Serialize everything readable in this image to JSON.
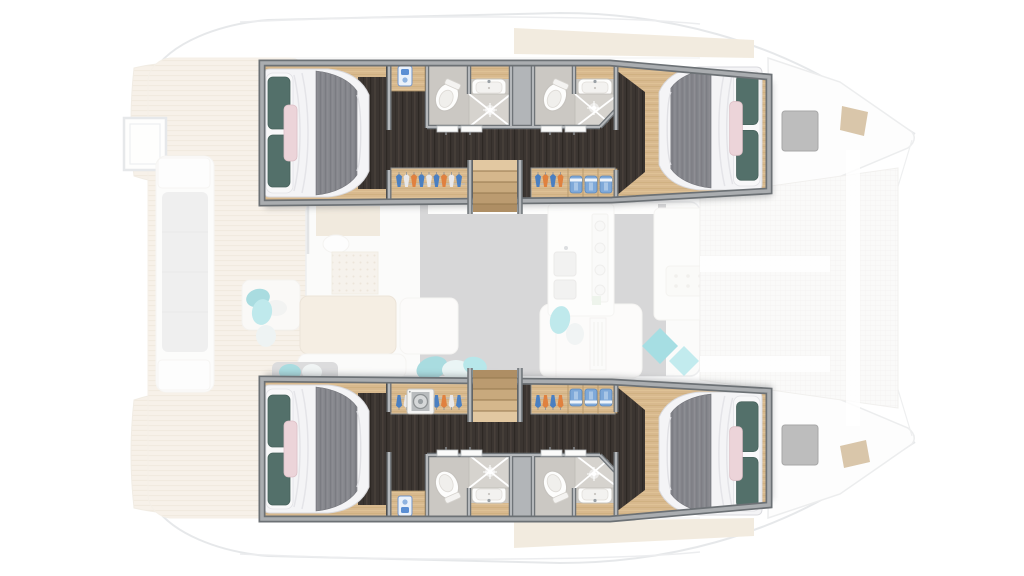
{
  "plan": {
    "title_label": "Catamaran yacht floor plan - 4-cabin lower deck layout, bow to the right",
    "regions": {
      "deck_faded": "Main deck (dimmed): aft cockpit, salon, galley, foredeck",
      "port_suite": "Port hull suite: aft cabin, two bathrooms, wardrobes, stairs, forward cabin",
      "starboard_suite": "Starboard hull suite: aft cabin, two bathrooms, wardrobes, stairs, forward cabin",
      "aft_cabin": "Aft double cabin",
      "forward_cabin": "Forward double cabin",
      "bathroom_aft": "Aft en-suite bathroom with toilet, basin and shower",
      "bathroom_fwd": "Forward en-suite bathroom with toilet, basin and shower",
      "wardrobe_aft": "Wardrobe with hangers",
      "wardrobe_fwd": "Wardrobe with hangers and folded shelves",
      "stairs": "Companionway stairs to saloon",
      "cockpit": "Aft cockpit lounge (dimmed)",
      "salon": "Saloon with dining table and chaise (dimmed)",
      "galley": "Galley with sink and stove (dimmed)",
      "fore_cockpit": "Forward cockpit bench (dimmed)",
      "trampoline": "Bow trampoline net (dimmed)",
      "washer": "Washing machine",
      "swim_platform": "Side boarding platform (dimmed)",
      "deck_hatch": "Deck hatch",
      "bow_pad": "Bow sun pad"
    }
  },
  "palette": {
    "wall_fill": "#aaadb0",
    "wall_line": "#6c7175",
    "floor_dark": "#3b3531",
    "wood": "#d8b98e",
    "bed_duvet": "#f4f4f6",
    "bed_blanket": "#85868c",
    "pillow_teal": "#53706a",
    "pillow_blush": "#ecd4d9",
    "bath_floor": "#cbc8c3",
    "shower_pan": "#d6d3ce",
    "fixture_white": "#fdfdfc",
    "stair_wood": "#d8bb91",
    "hanger_blue": "#4a7fc1",
    "hanger_orange": "#e0813f",
    "accent_cyan": "#a6dee3",
    "teak": "#ead9c1",
    "salon_floor": "#8c8c8e",
    "hatch_gray": "#bdbdbd"
  }
}
